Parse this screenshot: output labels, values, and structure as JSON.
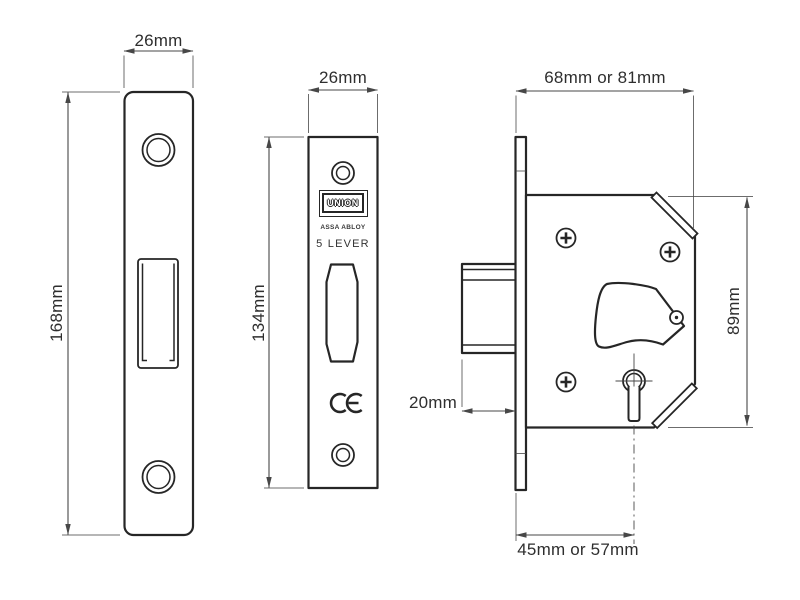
{
  "colors": {
    "outline": "#262626",
    "dimension": "#474747",
    "text": "#2e2e2e",
    "background": "#ffffff"
  },
  "views": {
    "strike_plate": {
      "width_label": "26mm",
      "height_label": "168mm"
    },
    "faceplate": {
      "width_label": "26mm",
      "height_label": "134mm",
      "logo_text": "UNION",
      "logo_sub_text": "ASSA ABLOY",
      "variant_label": "5 LEVER"
    },
    "lock_body": {
      "width_label": "68mm or 81mm",
      "height_label": "89mm",
      "bolt_throw_label": "20mm",
      "backset_label": "45mm or 57mm"
    }
  }
}
